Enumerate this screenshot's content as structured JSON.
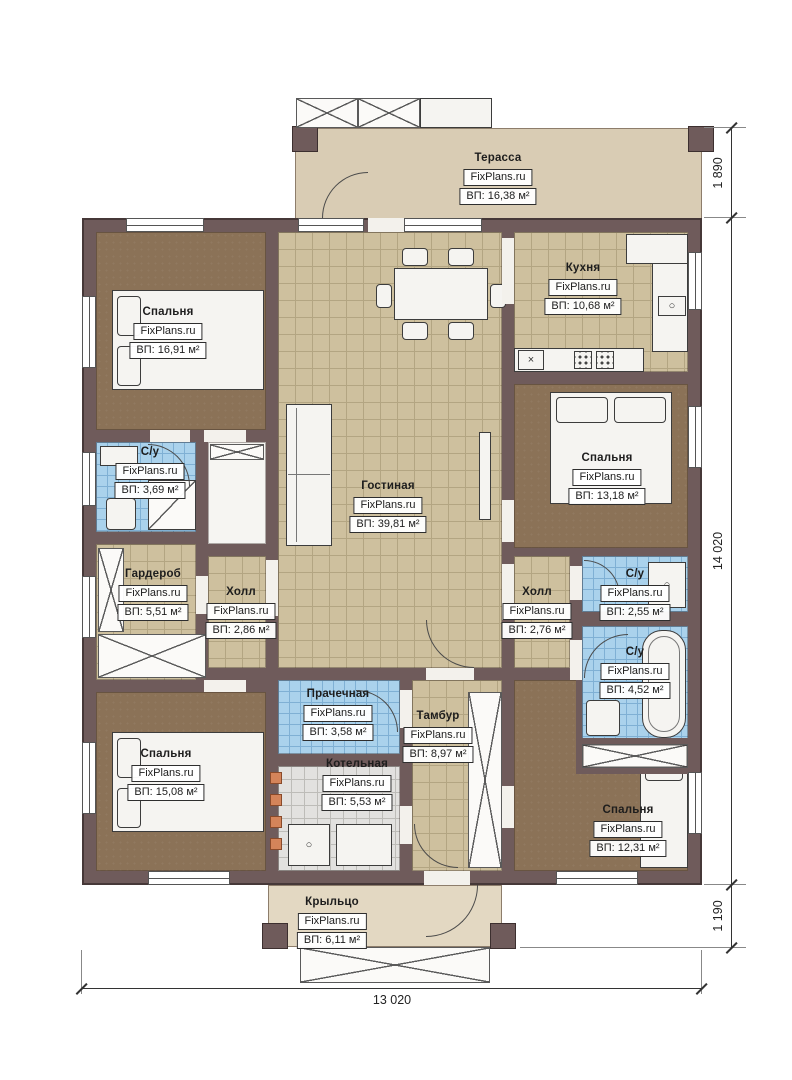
{
  "watermark": "FixPlans.ru",
  "rooms": [
    {
      "name": "Терасса",
      "area": "ВП: 16,38 м²"
    },
    {
      "name": "Спальня",
      "area": "ВП: 16,91 м²"
    },
    {
      "name": "Кухня",
      "area": "ВП: 10,68 м²"
    },
    {
      "name": "Спальня",
      "area": "ВП: 13,18 м²"
    },
    {
      "name": "С/у",
      "area": "ВП: 3,69 м²"
    },
    {
      "name": "Гостиная",
      "area": "ВП: 39,81 м²"
    },
    {
      "name": "Гардероб",
      "area": "ВП: 5,51 м²"
    },
    {
      "name": "Холл",
      "area": "ВП: 2,86 м²"
    },
    {
      "name": "Холл",
      "area": "ВП: 2,76 м²"
    },
    {
      "name": "С/у",
      "area": "ВП: 2,55 м²"
    },
    {
      "name": "С/у",
      "area": "ВП: 4,52 м²"
    },
    {
      "name": "Спальня",
      "area": "ВП: 15,08 м²"
    },
    {
      "name": "Прачечная",
      "area": "ВП: 3,58 м²"
    },
    {
      "name": "Тамбур",
      "area": "ВП: 8,97 м²"
    },
    {
      "name": "Котельная",
      "area": "ВП: 5,53 м²"
    },
    {
      "name": "Спальня",
      "area": "ВП: 12,31 м²"
    },
    {
      "name": "Крыльцо",
      "area": "ВП: 6,11 м²"
    }
  ],
  "dims": {
    "terrace_depth": "1 890",
    "house_height": "14 020",
    "porch_depth": "1 190",
    "house_width": "13 020"
  },
  "icons": {
    "sink_mark": "×",
    "burner_ring": "○"
  },
  "colors": {
    "wall": "#6f5b5b",
    "tile_tan": "#cec09e",
    "tile_tan_line": "#b3a582",
    "tile_blue": "#aad2ec",
    "tile_blue_line": "#7fb0d4",
    "tile_gray": "#e2e1df",
    "tile_gray_line": "#bdbcb8",
    "floor_brown": "#8b7257",
    "terrace": "#d9ccb4",
    "porch": "#e3d8c2",
    "accent_orange": "#d4845a"
  }
}
